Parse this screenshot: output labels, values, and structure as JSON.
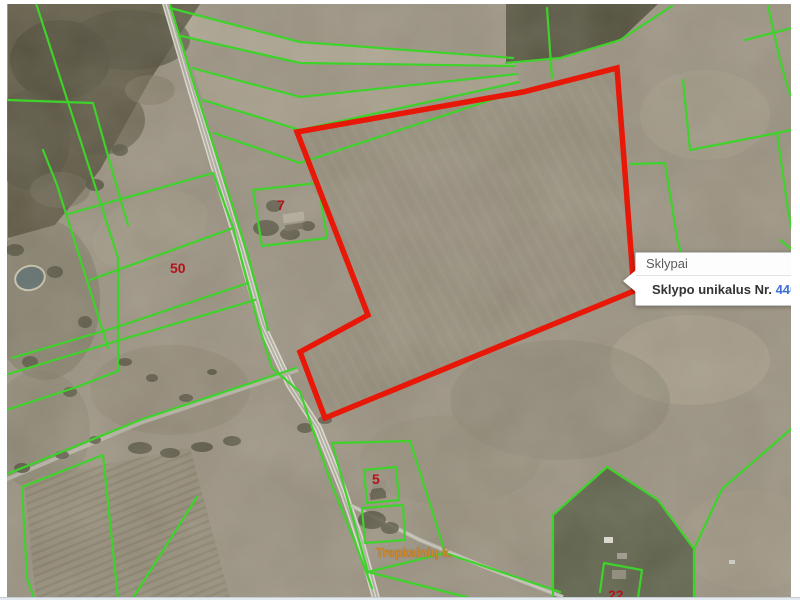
{
  "map": {
    "labels": {
      "l50": "50",
      "l7": "7",
      "l5": "5",
      "l22": "22",
      "village": "Trepkalnių k."
    },
    "colors": {
      "boundary_green": "#3ed32a",
      "selection_red": "#e81809",
      "label_red": "#b5121b",
      "village_orange": "#d0882c",
      "link_blue": "#3b6fd4"
    }
  },
  "popup": {
    "title": "Sklypai",
    "field_label": "Sklypo unikalus Nr.",
    "field_value": "4400-30"
  }
}
